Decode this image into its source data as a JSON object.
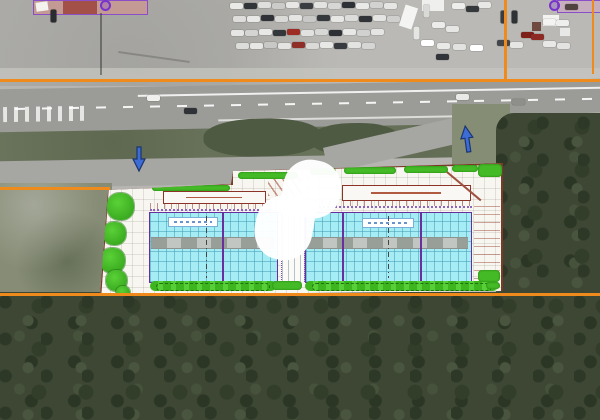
{
  "colors": {
    "lot_gray": "#b6b5b1",
    "road_gray": "#9b9b97",
    "grass_green": "#7b836b",
    "forest_green": "#3d4734",
    "orange_line": "#ef8b1d",
    "arrow_blue": "#3c6cd4",
    "arrow_outline": "#1c3570",
    "plan_purple": "#6a2f9e",
    "roof_cyan": "#a5ecf4",
    "hedge_green": "#44bb26",
    "canopy_red": "#8b3328",
    "pink_roof": "#c39a94"
  },
  "annotations": {
    "arrows": [
      {
        "name": "site-entrance-arrow-west",
        "direction": "down"
      },
      {
        "name": "site-entrance-arrow-east",
        "direction": "up"
      }
    ],
    "watermark": "white-interlocked-logo"
  },
  "markers": {
    "purple_dots": [
      {
        "x": 100,
        "y": 0
      },
      {
        "x": 549,
        "y": 0
      }
    ]
  },
  "vehicles": {
    "parked": [
      {
        "x": 230,
        "y": 3,
        "c": "#e9e9e7"
      },
      {
        "x": 244,
        "y": 3,
        "c": "#313539"
      },
      {
        "x": 258,
        "y": 2,
        "c": "#dfdfdd"
      },
      {
        "x": 272,
        "y": 3,
        "c": "#cbcbc9"
      },
      {
        "x": 286,
        "y": 2,
        "c": "#e7e7e5"
      },
      {
        "x": 300,
        "y": 3,
        "c": "#393d41"
      },
      {
        "x": 314,
        "y": 2,
        "c": "#e3e3e1"
      },
      {
        "x": 328,
        "y": 3,
        "c": "#d7d7d5"
      },
      {
        "x": 342,
        "y": 2,
        "c": "#2e3236"
      },
      {
        "x": 356,
        "y": 3,
        "c": "#e9e9e7"
      },
      {
        "x": 370,
        "y": 2,
        "c": "#d2d2d0"
      },
      {
        "x": 384,
        "y": 3,
        "c": "#e6e6e4"
      },
      {
        "x": 233,
        "y": 16,
        "c": "#dedddb"
      },
      {
        "x": 247,
        "y": 16,
        "c": "#e8e8e6"
      },
      {
        "x": 261,
        "y": 15,
        "c": "#2f3337"
      },
      {
        "x": 275,
        "y": 16,
        "c": "#d9d9d7"
      },
      {
        "x": 289,
        "y": 15,
        "c": "#e5e5e3"
      },
      {
        "x": 303,
        "y": 16,
        "c": "#c9c9c7"
      },
      {
        "x": 317,
        "y": 15,
        "c": "#35393d"
      },
      {
        "x": 331,
        "y": 16,
        "c": "#e7e7e5"
      },
      {
        "x": 345,
        "y": 15,
        "c": "#dcdcda"
      },
      {
        "x": 359,
        "y": 16,
        "c": "#303438"
      },
      {
        "x": 373,
        "y": 15,
        "c": "#e4e4e2"
      },
      {
        "x": 387,
        "y": 16,
        "c": "#cfcfcd"
      },
      {
        "x": 231,
        "y": 30,
        "c": "#e6e6e4"
      },
      {
        "x": 245,
        "y": 30,
        "c": "#d4d4d2"
      },
      {
        "x": 259,
        "y": 29,
        "c": "#e9e9e7"
      },
      {
        "x": 273,
        "y": 30,
        "c": "#33373b"
      },
      {
        "x": 287,
        "y": 29,
        "c": "#9e2b24"
      },
      {
        "x": 301,
        "y": 30,
        "c": "#e2e2e0"
      },
      {
        "x": 315,
        "y": 29,
        "c": "#d8d8d6"
      },
      {
        "x": 329,
        "y": 30,
        "c": "#2d3135"
      },
      {
        "x": 343,
        "y": 29,
        "c": "#e8e8e6"
      },
      {
        "x": 357,
        "y": 30,
        "c": "#d1d1cf"
      },
      {
        "x": 371,
        "y": 29,
        "c": "#e5e5e3"
      },
      {
        "x": 236,
        "y": 43,
        "c": "#dcdcda"
      },
      {
        "x": 250,
        "y": 43,
        "c": "#e7e7e5"
      },
      {
        "x": 264,
        "y": 42,
        "c": "#c8c8c6"
      },
      {
        "x": 278,
        "y": 43,
        "c": "#e4e4e2"
      },
      {
        "x": 292,
        "y": 42,
        "c": "#8f2e27"
      },
      {
        "x": 306,
        "y": 43,
        "c": "#dadad8"
      },
      {
        "x": 320,
        "y": 42,
        "c": "#e8e8e6"
      },
      {
        "x": 334,
        "y": 43,
        "c": "#373b3f"
      },
      {
        "x": 348,
        "y": 42,
        "c": "#e3e3e1"
      },
      {
        "x": 362,
        "y": 43,
        "c": "#d6d6d4"
      },
      {
        "x": 478,
        "y": 2,
        "c": "#e8e8e6"
      },
      {
        "x": 452,
        "y": 3,
        "c": "#eeeeec"
      },
      {
        "x": 466,
        "y": 6,
        "c": "#36393c"
      },
      {
        "x": 497,
        "y": 14,
        "c": "#3a3d40",
        "v": true
      },
      {
        "x": 508,
        "y": 14,
        "c": "#2f3235",
        "v": true
      },
      {
        "x": 432,
        "y": 22,
        "c": "#ececea"
      },
      {
        "x": 446,
        "y": 26,
        "c": "#e6e6e4"
      },
      {
        "x": 421,
        "y": 40,
        "c": "#ffffff"
      },
      {
        "x": 437,
        "y": 43,
        "c": "#e9e9e7"
      },
      {
        "x": 453,
        "y": 44,
        "c": "#e2e2e0"
      },
      {
        "x": 470,
        "y": 45,
        "c": "#ffffff"
      },
      {
        "x": 497,
        "y": 40,
        "c": "#44474a"
      },
      {
        "x": 510,
        "y": 42,
        "c": "#e6e6e4"
      },
      {
        "x": 521,
        "y": 32,
        "c": "#7e1f1a"
      },
      {
        "x": 531,
        "y": 34,
        "c": "#8e2a24"
      },
      {
        "x": 543,
        "y": 19,
        "c": "#f4f4f2"
      },
      {
        "x": 556,
        "y": 20,
        "c": "#eff0ee"
      },
      {
        "x": 543,
        "y": 41,
        "c": "#e8e8e6"
      },
      {
        "x": 557,
        "y": 43,
        "c": "#e3e3e1"
      },
      {
        "x": 420,
        "y": 8,
        "c": "#d9d9d7",
        "v": true
      },
      {
        "x": 410,
        "y": 30,
        "c": "#e5e5e3",
        "v": true
      },
      {
        "x": 436,
        "y": 54,
        "c": "#313438"
      },
      {
        "x": 565,
        "y": 4,
        "c": "#50423e"
      },
      {
        "x": 47,
        "y": 13,
        "c": "#2a2d30",
        "v": true
      }
    ],
    "on_road": [
      {
        "x": 147,
        "y": 95,
        "c": "#f0f0ee"
      },
      {
        "x": 184,
        "y": 108,
        "c": "#2f3236"
      },
      {
        "x": 456,
        "y": 94,
        "c": "#e9e9e7"
      },
      {
        "x": 512,
        "y": 99,
        "c": "#8e8e8a"
      }
    ]
  },
  "plan": {
    "bushes": [
      {
        "x": 152,
        "y": 185,
        "w": 78,
        "h": 6
      },
      {
        "x": 238,
        "y": 172,
        "w": 60,
        "h": 7
      },
      {
        "x": 310,
        "y": 168,
        "w": 26,
        "h": 7
      },
      {
        "x": 344,
        "y": 167,
        "w": 52,
        "h": 7
      },
      {
        "x": 404,
        "y": 166,
        "w": 44,
        "h": 7
      },
      {
        "x": 452,
        "y": 165,
        "w": 26,
        "h": 7
      },
      {
        "x": 478,
        "y": 164,
        "w": 24,
        "h": 13
      },
      {
        "x": 478,
        "y": 270,
        "w": 22,
        "h": 12
      },
      {
        "x": 486,
        "y": 282,
        "w": 14,
        "h": 7
      },
      {
        "x": 272,
        "y": 281,
        "w": 30,
        "h": 9
      }
    ],
    "trees": [
      {
        "x": 107,
        "y": 193,
        "s": 27
      },
      {
        "x": 103,
        "y": 222,
        "s": 23
      },
      {
        "x": 100,
        "y": 248,
        "s": 25
      },
      {
        "x": 106,
        "y": 270,
        "s": 21
      },
      {
        "x": 116,
        "y": 286,
        "s": 14
      }
    ]
  }
}
